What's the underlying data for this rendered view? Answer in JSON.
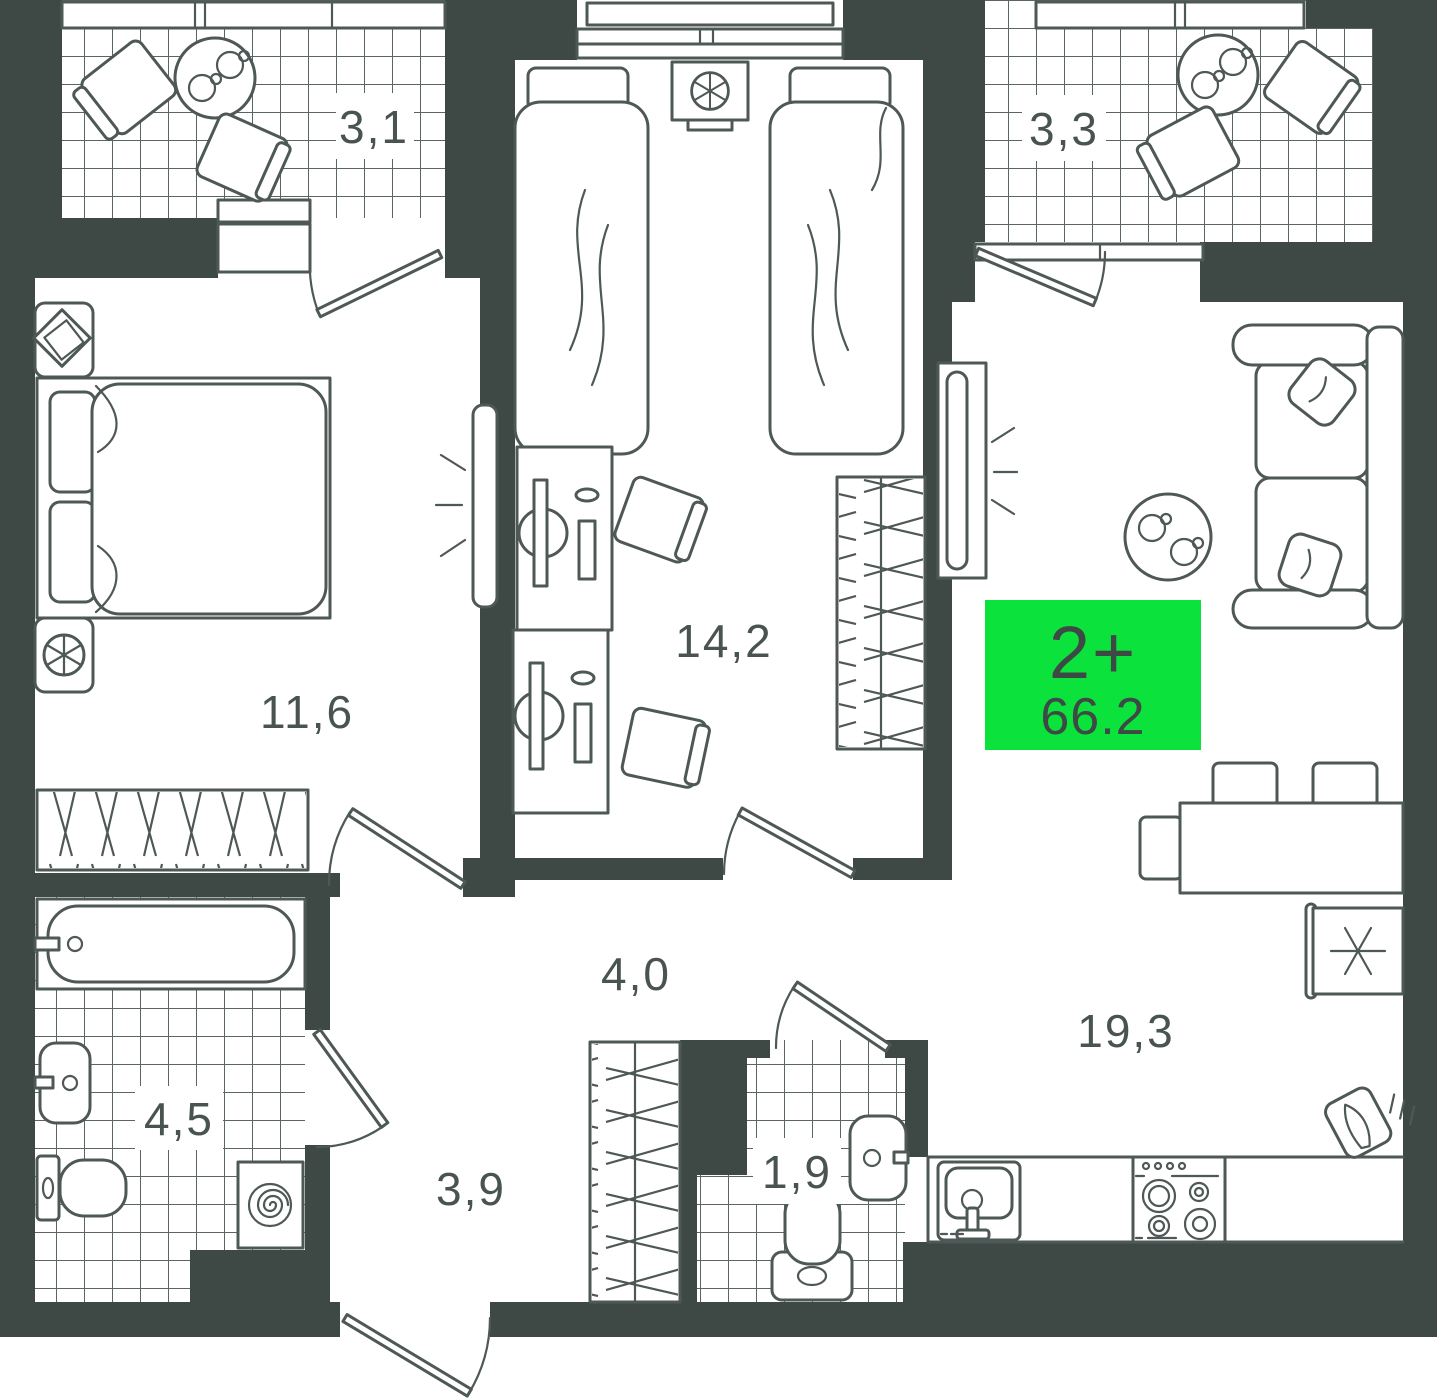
{
  "plan": {
    "type_badge": {
      "label": "2+",
      "area": "66.2"
    },
    "rooms": [
      {
        "name": "balcony-1",
        "label": "3,1"
      },
      {
        "name": "balcony-2",
        "label": "3,3"
      },
      {
        "name": "bedroom",
        "label": "11,6"
      },
      {
        "name": "children-room",
        "label": "14,2"
      },
      {
        "name": "corridor",
        "label": "4,0"
      },
      {
        "name": "bathroom",
        "label": "4,5"
      },
      {
        "name": "hall",
        "label": "3,9"
      },
      {
        "name": "wc",
        "label": "1,9"
      },
      {
        "name": "kitchen-living",
        "label": "19,3"
      }
    ],
    "colors": {
      "wall": "#3E4845",
      "line": "#4E5856",
      "tile": "#5A6462",
      "label": "#49534F",
      "green": "#0BE23C",
      "bg": "#FFFFFF"
    }
  }
}
